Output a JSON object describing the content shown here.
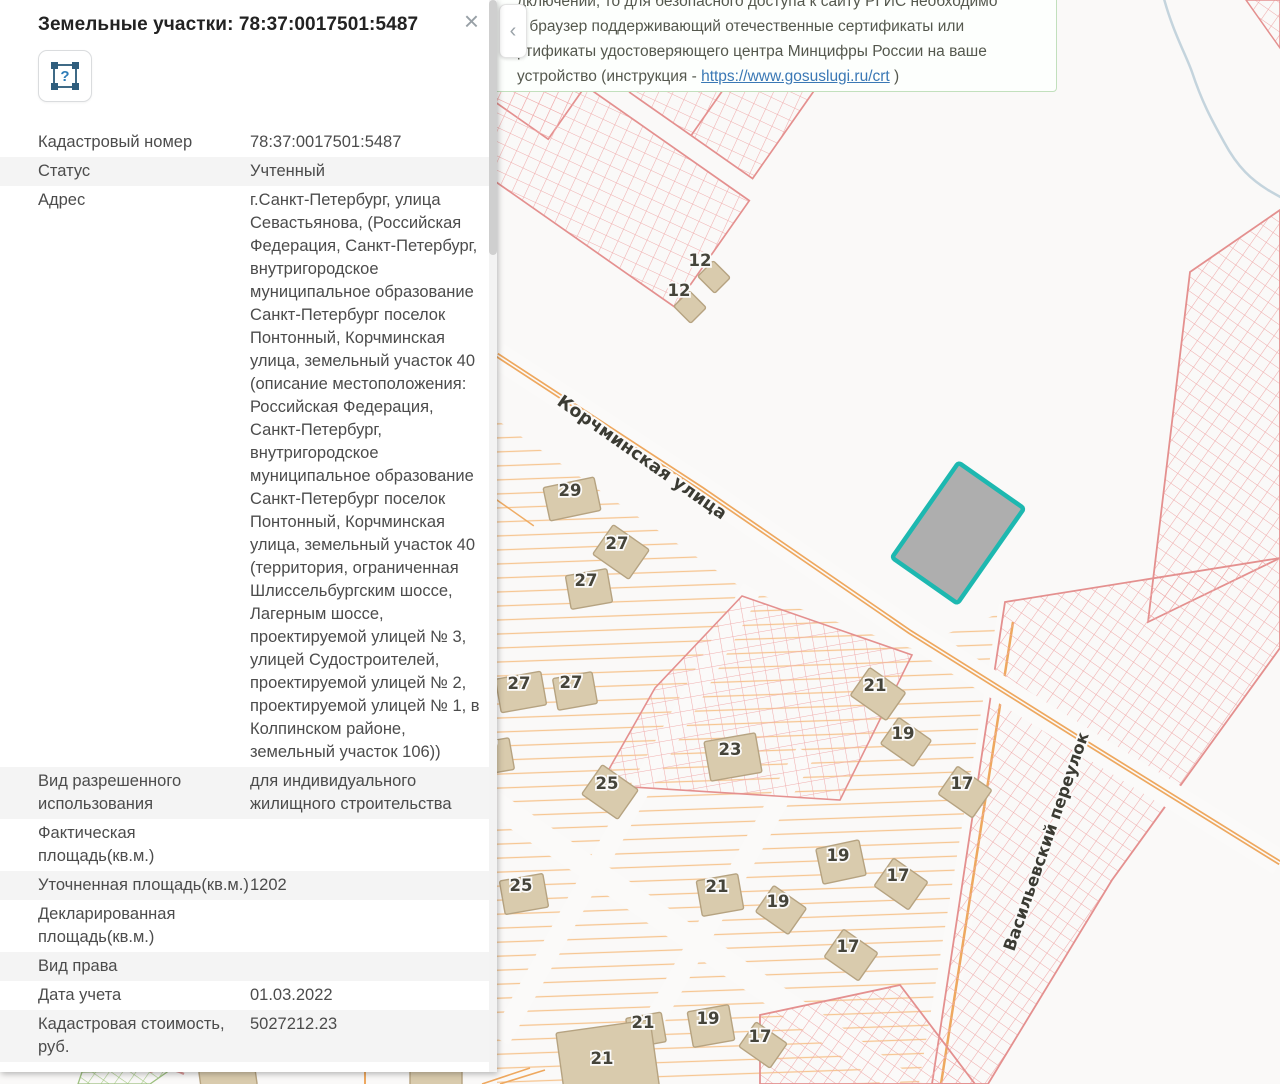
{
  "panel": {
    "title": "Земельные участки: 78:37:0017501:5487",
    "close_label": "×",
    "identify_tool_label": "?",
    "rows": [
      {
        "label": "Кадастровый номер",
        "value": "78:37:0017501:5487",
        "shaded": false
      },
      {
        "label": "Статус",
        "value": "Учтенный",
        "shaded": true
      },
      {
        "label": "Адрес",
        "value": "г.Санкт-Петербург, улица Севастьянова, (Российская Федерация, Санкт-Петербург, внутригородское муниципальное образование Санкт-Петербург поселок Понтонный, Корчминская улица, земельный участок 40 (описание местоположения: Российская Федерация, Санкт-Петербург, внутригородское муниципальное образование Санкт-Петербург поселок Понтонный, Корчминская улица, земельный участок 40 (территория, ограниченная Шлиссельбургским шоссе, Лагерным шоссе, проектируемой улицей № 3, улицей Судостроителей, проектируемой улицей № 2, проектируемой улицей № 1, в Колпинском районе, земельный участок 106))",
        "shaded": false
      },
      {
        "label": "Вид разрешенного использования",
        "value": "для индивидуального жилищного строительства",
        "shaded": true
      },
      {
        "label": "Фактическая площадь(кв.м.)",
        "value": "",
        "shaded": false
      },
      {
        "label": "Уточненная площадь(кв.м.)",
        "value": "1202",
        "shaded": true
      },
      {
        "label": "Декларированная площадь(кв.м.)",
        "value": "",
        "shaded": false
      },
      {
        "label": "Вид права",
        "value": "",
        "shaded": true
      },
      {
        "label": "Дата учета",
        "value": "01.03.2022",
        "shaded": false
      },
      {
        "label": "Кадастровая стоимость, руб.",
        "value": "5027212.23",
        "shaded": true
      }
    ]
  },
  "notification": {
    "lines": [
      "дключений, то для безопасного доступа к сайту РГИС необходимо",
      "ь браузер поддерживающий отечественные сертификаты или",
      "ртификаты удостоверяющего центра Минцифры России на ваше"
    ],
    "last_line_prefix": "устройство (инструкция - ",
    "link_text": "https://www.gosuslugi.ru/crt",
    "last_line_suffix": " )"
  },
  "collapse_chevron": "‹",
  "map": {
    "selected_parcel": {
      "cadastral_number": "78:37:0017501:5487",
      "border_color": "#1db8b0",
      "fill_color": "#999999"
    },
    "streets": [
      {
        "name": "Корчминская улица"
      },
      {
        "name": "Васильевский переулок"
      }
    ],
    "parcel_labels": [
      {
        "t": "12",
        "x": 700,
        "y": 266
      },
      {
        "t": "12",
        "x": 679,
        "y": 296
      },
      {
        "t": "29",
        "x": 570,
        "y": 496
      },
      {
        "t": "27",
        "x": 617,
        "y": 549
      },
      {
        "t": "27",
        "x": 586,
        "y": 586
      },
      {
        "t": "27",
        "x": 519,
        "y": 689
      },
      {
        "t": "27",
        "x": 571,
        "y": 688
      },
      {
        "t": "27",
        "x": 486,
        "y": 754
      },
      {
        "t": "25",
        "x": 607,
        "y": 789
      },
      {
        "t": "23",
        "x": 730,
        "y": 755
      },
      {
        "t": "21",
        "x": 875,
        "y": 691
      },
      {
        "t": "19",
        "x": 903,
        "y": 739
      },
      {
        "t": "17",
        "x": 962,
        "y": 789
      },
      {
        "t": "25",
        "x": 521,
        "y": 891
      },
      {
        "t": "19",
        "x": 838,
        "y": 861
      },
      {
        "t": "17",
        "x": 898,
        "y": 881
      },
      {
        "t": "21",
        "x": 717,
        "y": 892
      },
      {
        "t": "19",
        "x": 778,
        "y": 907
      },
      {
        "t": "17",
        "x": 848,
        "y": 952
      },
      {
        "t": "19",
        "x": 708,
        "y": 1024
      },
      {
        "t": "21",
        "x": 643,
        "y": 1028
      },
      {
        "t": "17",
        "x": 760,
        "y": 1042
      },
      {
        "t": "21",
        "x": 602,
        "y": 1064
      }
    ],
    "buildings": [
      [
        714,
        277,
        24,
        22,
        45
      ],
      [
        690,
        307,
        24,
        22,
        45
      ],
      [
        572,
        499,
        52,
        34,
        -12
      ],
      [
        621,
        552,
        44,
        36,
        35
      ],
      [
        589,
        589,
        42,
        34,
        -10
      ],
      [
        521,
        692,
        46,
        34,
        -10
      ],
      [
        575,
        691,
        40,
        32,
        -10
      ],
      [
        492,
        757,
        40,
        32,
        -10
      ],
      [
        610,
        792,
        44,
        36,
        35
      ],
      [
        733,
        757,
        52,
        40,
        -10
      ],
      [
        878,
        694,
        44,
        34,
        35
      ],
      [
        906,
        742,
        40,
        32,
        35
      ],
      [
        965,
        792,
        42,
        34,
        35
      ],
      [
        524,
        894,
        44,
        34,
        -10
      ],
      [
        841,
        862,
        44,
        36,
        -12
      ],
      [
        901,
        884,
        42,
        34,
        35
      ],
      [
        720,
        895,
        42,
        36,
        -10
      ],
      [
        781,
        910,
        40,
        32,
        35
      ],
      [
        851,
        955,
        42,
        34,
        35
      ],
      [
        711,
        1026,
        42,
        36,
        -10
      ],
      [
        646,
        1030,
        36,
        30,
        -10
      ],
      [
        763,
        1045,
        38,
        30,
        35
      ],
      [
        608,
        1062,
        95,
        72,
        -8
      ],
      [
        228,
        1078,
        56,
        22,
        -8
      ],
      [
        436,
        1080,
        52,
        20,
        0
      ]
    ],
    "colors": {
      "background": "#faf9f8",
      "red_parcel_outline": "#e4908f",
      "red_hatch": "#f0aeae",
      "road_orange": "#eea85f",
      "residential_hatch": "#f6c692",
      "building_fill": "#d9cbad",
      "stream_blue": "#c4d4dd",
      "green_hatch": "#a9cc8b"
    }
  }
}
